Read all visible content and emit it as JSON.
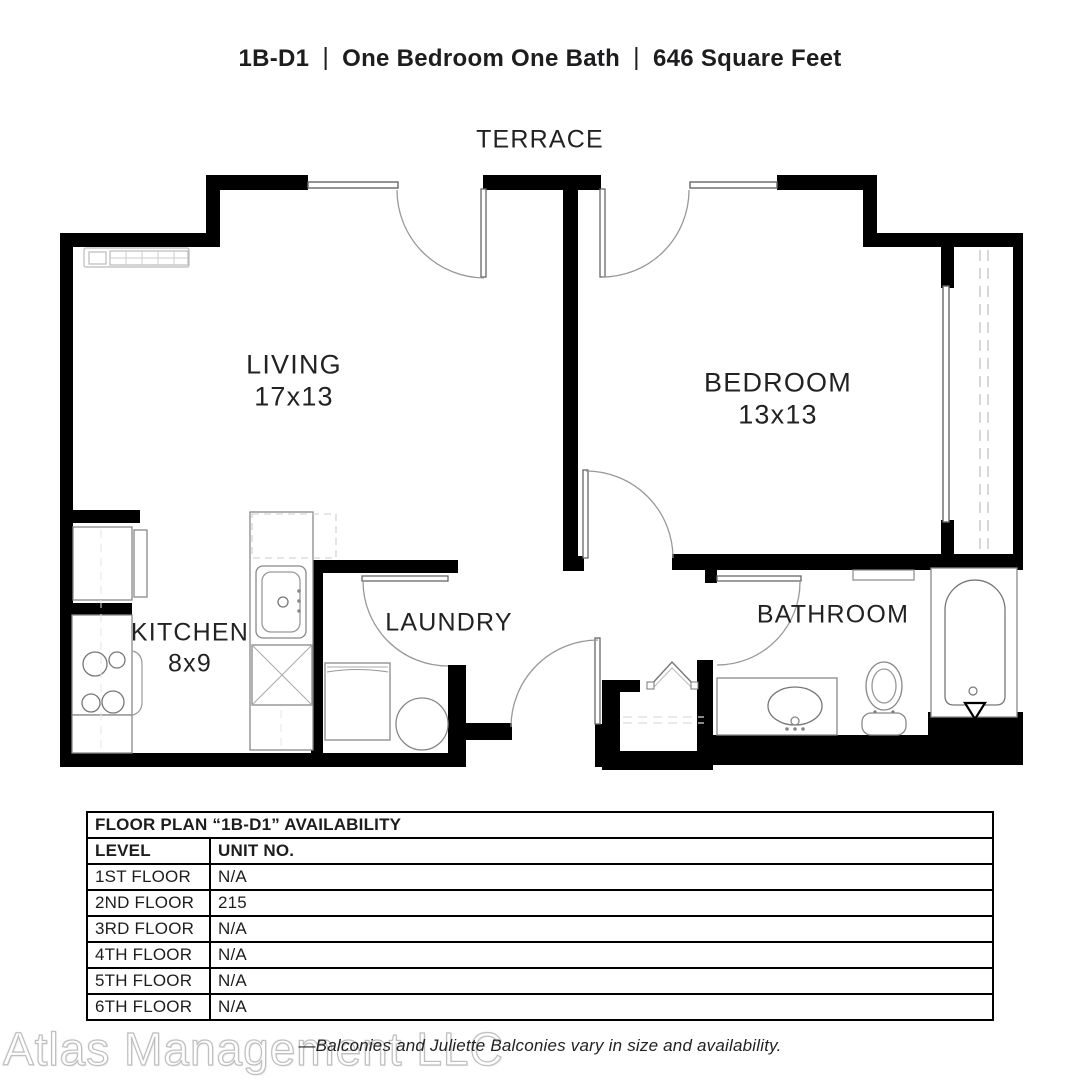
{
  "header": {
    "code": "1B-D1",
    "separator": "|",
    "unit_type": "One Bedroom One Bath",
    "area": "646 Square Feet"
  },
  "floorplan": {
    "rooms": {
      "terrace": "TERRACE",
      "living": {
        "name": "LIVING",
        "dims": "17x13"
      },
      "bedroom": {
        "name": "BEDROOM",
        "dims": "13x13"
      },
      "kitchen": {
        "name": "KITCHEN",
        "dims": "8x9"
      },
      "laundry": "LAUNDRY",
      "bathroom": "BATHROOM"
    },
    "fixtures": [
      "baseboard-heater",
      "refrigerator",
      "range",
      "kitchen-sink",
      "dishwasher",
      "washer",
      "water-heater",
      "entry-closet",
      "vanity-sink",
      "toilet",
      "bathtub",
      "wall-niche"
    ]
  },
  "availability_table": {
    "title": "FLOOR PLAN “1B-D1” AVAILABILITY",
    "columns": {
      "level": "LEVEL",
      "unit": "UNIT NO."
    },
    "rows": [
      {
        "level": "1ST FLOOR",
        "unit": "N/A"
      },
      {
        "level": "2ND FLOOR",
        "unit": "215"
      },
      {
        "level": "3RD FLOOR",
        "unit": "N/A"
      },
      {
        "level": "4TH FLOOR",
        "unit": "N/A"
      },
      {
        "level": "5TH FLOOR",
        "unit": "N/A"
      },
      {
        "level": "6TH FLOOR",
        "unit": "N/A"
      }
    ]
  },
  "footer": {
    "watermark": "Atlas Management LLC",
    "note": "—Balconies and Juliette Balconies vary in size and availability."
  },
  "colors": {
    "wall": "#000000",
    "thin_line": "#666666",
    "arc": "#999999",
    "dashed": "#cccccc"
  }
}
